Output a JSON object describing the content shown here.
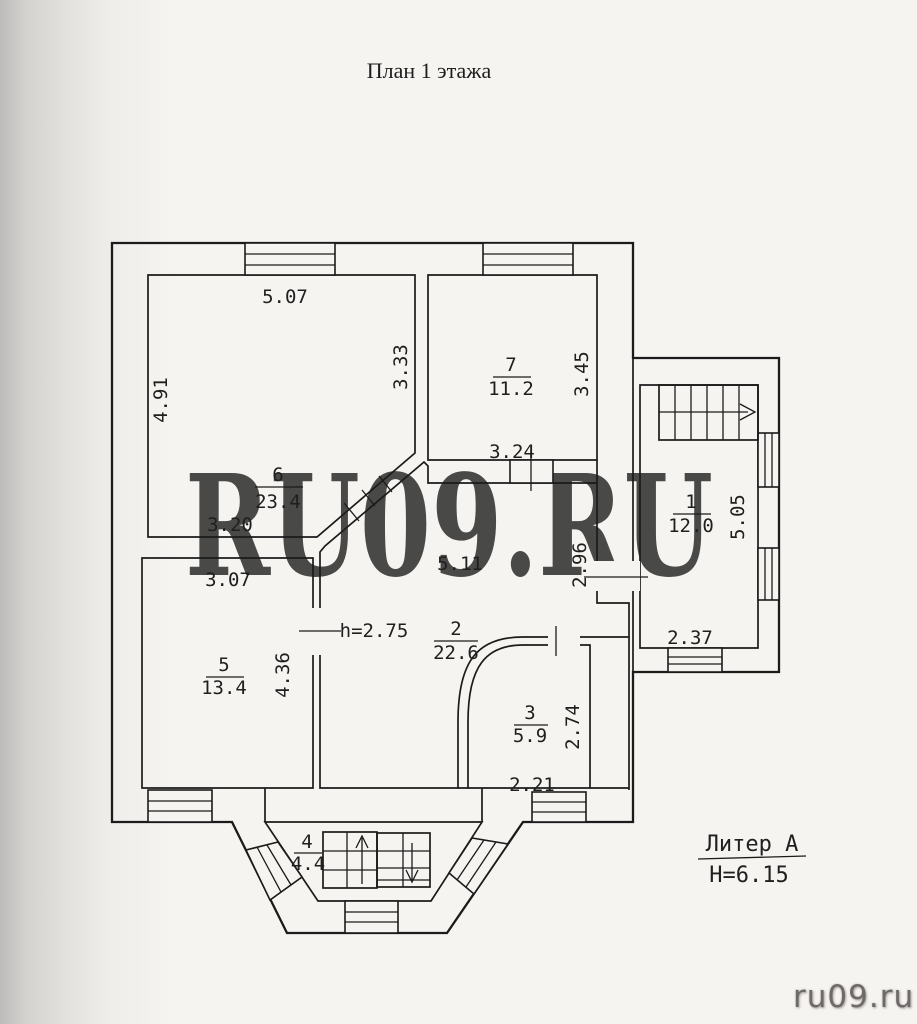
{
  "page": {
    "title": "План 1 этажа",
    "watermark": "RU09.RU",
    "credit": "ru09.ru"
  },
  "legend": {
    "liter": "Литер А",
    "building_height": "H=6.15"
  },
  "rooms": {
    "r1": {
      "number": "1",
      "area": "12.0"
    },
    "r2": {
      "number": "2",
      "area": "22.6"
    },
    "r3": {
      "number": "3",
      "area": "5.9"
    },
    "r4": {
      "number": "4",
      "area": "4.4"
    },
    "r5": {
      "number": "5",
      "area": "13.4"
    },
    "r6": {
      "number": "6",
      "area": "23.4"
    },
    "r7": {
      "number": "7",
      "area": "11.2"
    }
  },
  "dims": {
    "r6_top": "5.07",
    "r6_left": "4.91",
    "r6_right": "3.33",
    "r6_bottom": "3.20",
    "r7_right": "3.45",
    "r7_bottom": "3.24",
    "r1_right": "5.05",
    "r1_bottom": "2.37",
    "r2_top": "5.11",
    "r2_ceiling": "h=2.75",
    "r2_right": "2.96",
    "r5_top": "3.07",
    "r5_right": "4.36",
    "r3_right": "2.74",
    "r3_bottom": "2.21"
  },
  "colors": {
    "line": "#1b1b1b",
    "watermark": "#d2d1cf",
    "credit": "#6e6a6a"
  }
}
